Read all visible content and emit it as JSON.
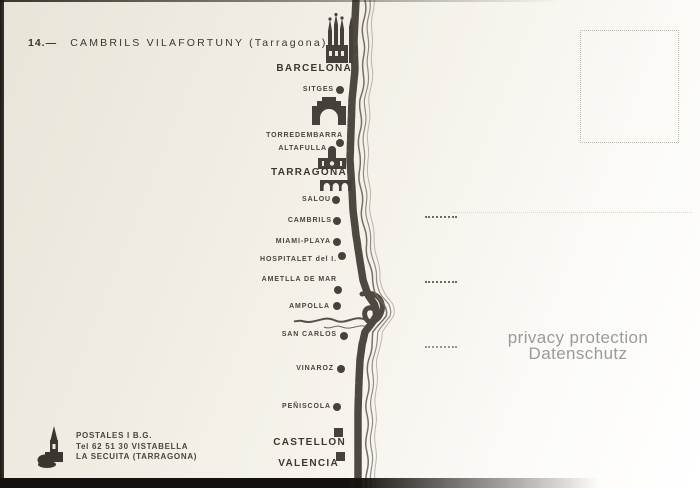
{
  "title": {
    "number": "14.—",
    "name": "CAMBRILS VILAFORTUNY",
    "region": "(Tarragona)"
  },
  "map": {
    "towns": [
      {
        "name": "BARCELONA",
        "marker": "none",
        "major": true
      },
      {
        "name": "SITGES",
        "marker": "dot",
        "major": false
      },
      {
        "name": "TORREDEMBARRA",
        "marker": "dot",
        "major": false
      },
      {
        "name": "ALTAFULLA",
        "marker": "dot",
        "major": false
      },
      {
        "name": "TARRAGONA",
        "marker": "none",
        "major": true
      },
      {
        "name": "SALOU",
        "marker": "dot",
        "major": false
      },
      {
        "name": "CAMBRILS",
        "marker": "dot",
        "major": false
      },
      {
        "name": "MIAMI-PLAYA",
        "marker": "dot",
        "major": false
      },
      {
        "name": "HOSPITALET del I.",
        "marker": "dot",
        "major": false
      },
      {
        "name": "AMETLLA DE MAR",
        "marker": "dot",
        "major": false
      },
      {
        "name": "AMPOLLA",
        "marker": "dot",
        "major": false
      },
      {
        "name": "SAN CARLOS",
        "marker": "dot",
        "major": false
      },
      {
        "name": "VINAROZ",
        "marker": "dot",
        "major": false
      },
      {
        "name": "PEÑISCOLA",
        "marker": "dot",
        "major": false
      },
      {
        "name": "CASTELLON",
        "marker": "square",
        "major": true
      },
      {
        "name": "VALENCIA",
        "marker": "square",
        "major": true
      }
    ],
    "icons": [
      "sagrada-familia-barcelona",
      "arc-de-bera",
      "tarragona-cathedral",
      "tarragona-aqueduct"
    ]
  },
  "publisher": {
    "lines": [
      "POSTALES I B.G.",
      "Tel  62 51 30 VISTABELLA",
      "LA SECUITA (TARRAGONA)"
    ]
  },
  "watermark": {
    "line1": "privacy protection",
    "line2": "Datenschutz"
  },
  "colors": {
    "ink": "#45403a",
    "road": "#4e4841",
    "coast": "#6e675e",
    "background": "#f1ede4",
    "watermark_gray": "#9a9a9a"
  }
}
